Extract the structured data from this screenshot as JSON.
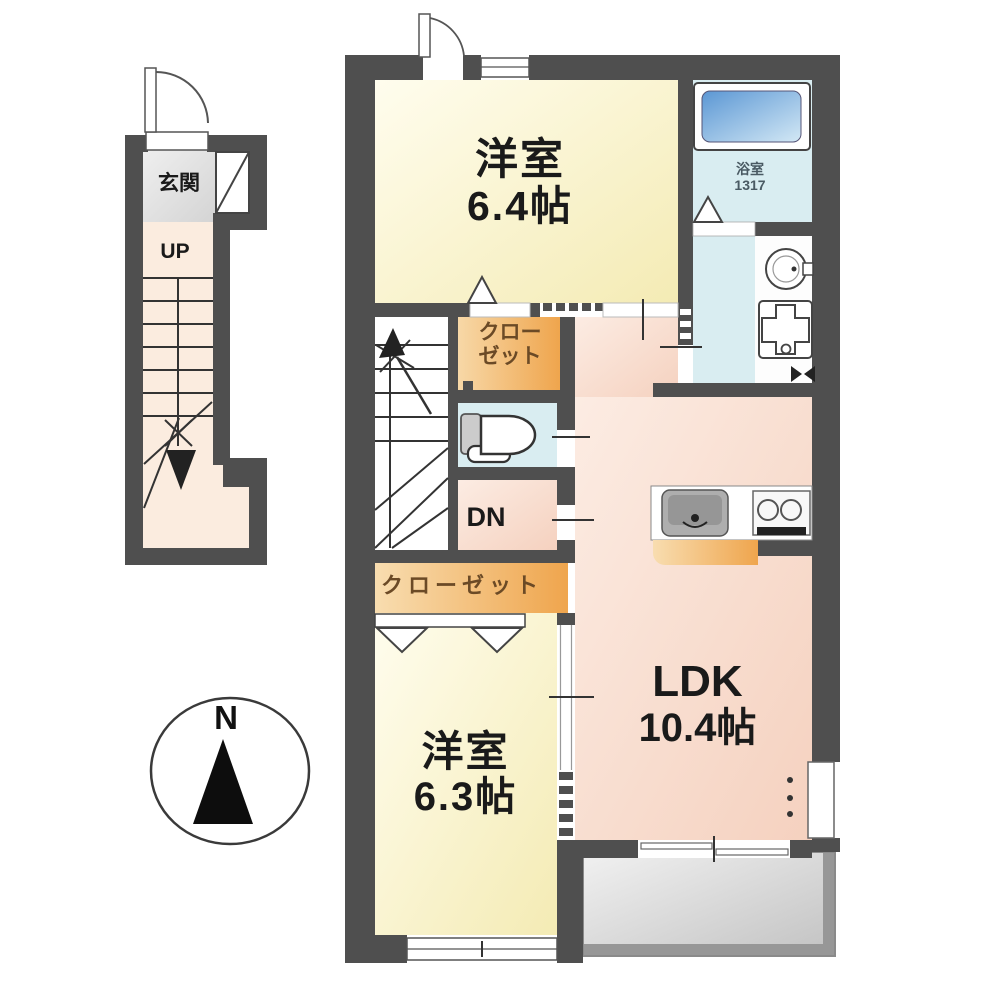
{
  "title": "2LDK apartment floor plan",
  "first_floor": {
    "genkan": "玄関",
    "up": "UP"
  },
  "second_floor": {
    "room_top_name": "洋室",
    "room_top_size": "6.4帖",
    "bath_name": "浴室",
    "bath_size": "1317",
    "closet_top_line1": "クロー",
    "closet_top_line2": "ゼット",
    "dn": "DN",
    "closet_bottom": "クローゼット",
    "room_bottom_name": "洋室",
    "room_bottom_size": "6.3帖",
    "ldk_name": "LDK",
    "ldk_size": "10.4帖"
  },
  "compass": {
    "north": "N"
  },
  "colors": {
    "wall": "#4f4f4f",
    "room-yellow": "#f8f0c4",
    "ldk-pink": "#f8dcce",
    "closet-orange": "#efa54d",
    "water": "#d9edf1",
    "tub-blue": "#5b97d4",
    "balcony-gray": "#c9c9c9",
    "cream": "#fbecdf",
    "genkan-gray": "#dedede",
    "ink": "#1a1a1a"
  }
}
